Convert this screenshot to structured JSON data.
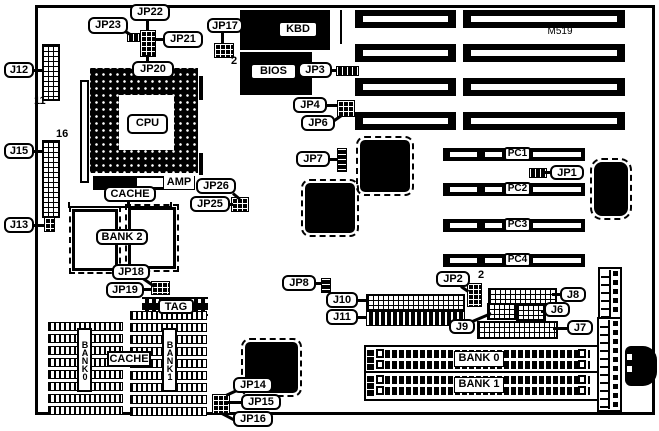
{
  "diagram": {
    "model": "M519"
  },
  "cpu": {
    "label": "CPU"
  },
  "chips": {
    "kbd": "KBD",
    "bios": "BIOS",
    "amp": "AMP",
    "tag": "TAG"
  },
  "cache": {
    "top_label": "CACHE",
    "bottom_label": "CACHE",
    "bank2": "BANK 2",
    "bank0_vertical": "BANK0",
    "bank1_vertical": "BANK1"
  },
  "simm": {
    "bank0": "BANK 0",
    "bank1": "BANK 1"
  },
  "pci_slots": [
    "PC1",
    "PC2",
    "PC3",
    "PC4"
  ],
  "callouts": {
    "j12": "J12",
    "j15": "J15",
    "j13": "J13",
    "jp23": "JP23",
    "jp22": "JP22",
    "jp21": "JP21",
    "jp20": "JP20",
    "jp17": "JP17",
    "jp3": "JP3",
    "jp4": "JP4",
    "jp6": "JP6",
    "jp7": "JP7",
    "jp26": "JP26",
    "jp25": "JP25",
    "jp18": "JP18",
    "jp19": "JP19",
    "jp14": "JP14",
    "jp15": "JP15",
    "jp16": "JP16",
    "jp8": "JP8",
    "jp2": "JP2",
    "jp1": "JP1",
    "j10": "J10",
    "j11": "J11",
    "j9": "J9",
    "j8": "J8",
    "j6": "J6",
    "j7": "J7"
  },
  "pin_numbers": {
    "j12": "11",
    "j15": "16",
    "jp17": "2",
    "jp2": "2"
  }
}
